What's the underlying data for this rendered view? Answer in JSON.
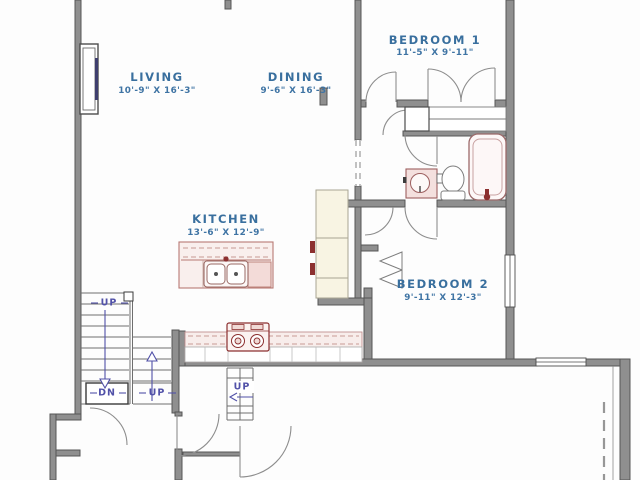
{
  "plan": {
    "type": "floor-plan",
    "rooms": [
      {
        "name": "LIVING",
        "dims": "10'-9\" X 16'-3\""
      },
      {
        "name": "DINING",
        "dims": "9'-6\" X 16'-3\""
      },
      {
        "name": "BEDROOM 1",
        "dims": "11'-5\" X 9'-11\""
      },
      {
        "name": "KITCHEN",
        "dims": "13'-6\" X 12'-9\""
      },
      {
        "name": "BEDROOM 2",
        "dims": "9'-11\" X 12'-3\""
      }
    ],
    "stairs": {
      "main_up": "UP",
      "main_dn": "DN",
      "basement_up": "UP",
      "entry_up": "UP"
    },
    "fixtures": [
      "window",
      "fireplace",
      "kitchen-island-sink",
      "dishwasher",
      "range-cooktop",
      "refrigerator",
      "pantry-cabinets",
      "bath-vanity-sink",
      "toilet",
      "bathtub",
      "bifold-closet-doors",
      "deck-line"
    ],
    "colors": {
      "wall": "#8f8f8f",
      "room_text": "#396f9e",
      "stair_text": "#5151a8",
      "fixture_outline": "#a06058",
      "fixture_accent": "#8c3030",
      "cabinet_cream": "#f8f4e3"
    }
  }
}
